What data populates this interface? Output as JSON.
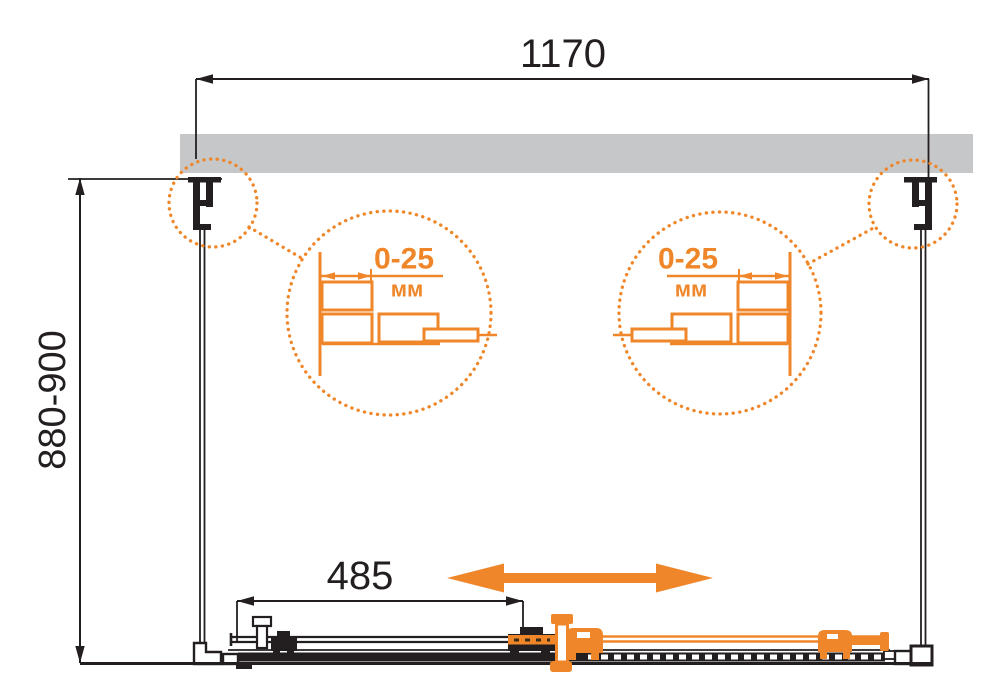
{
  "dimensions": {
    "width": "1170",
    "height": "880-900",
    "door_travel": "485"
  },
  "callout_left": {
    "value": "0-25",
    "unit": "мм"
  },
  "callout_right": {
    "value": "0-25",
    "unit": "мм"
  },
  "colors": {
    "accent_orange": "#EF872A",
    "wall_gray": "#C5C7C9",
    "line_black": "#231F20"
  },
  "icons": {
    "slide_direction": "double-headed-arrow"
  }
}
